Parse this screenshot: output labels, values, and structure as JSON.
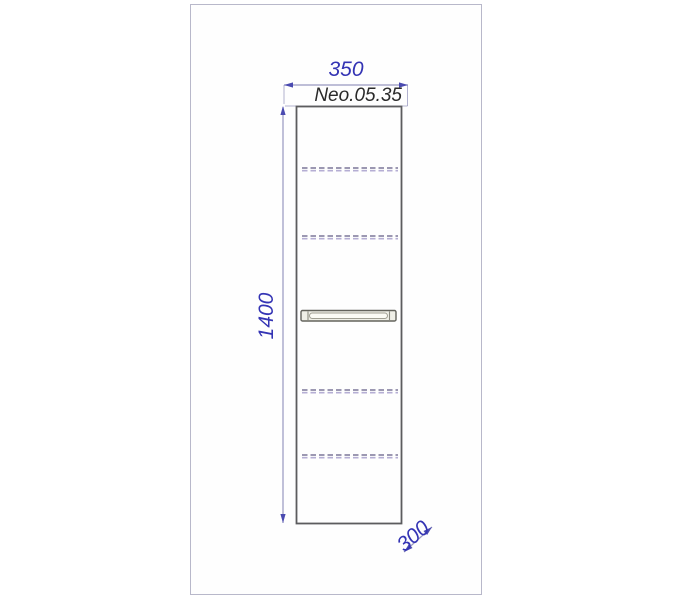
{
  "drawing": {
    "model_label": "Neo.05.35",
    "dimensions": {
      "width_label": "350",
      "height_label": "1400",
      "depth_label": "300"
    },
    "colors": {
      "dimension_text": "#3434b4",
      "dimension_line": "#9898c0",
      "arrow": "#4a4ab0",
      "outline": "#5c5c5e",
      "page_border": "#b8b8ca",
      "hidden_dark": "#8f8aa8",
      "hidden_light": "#b5aed4",
      "label_text": "#2a2a2a",
      "handle_fill": "#efefe7",
      "handle_stroke": "#63635c"
    }
  }
}
